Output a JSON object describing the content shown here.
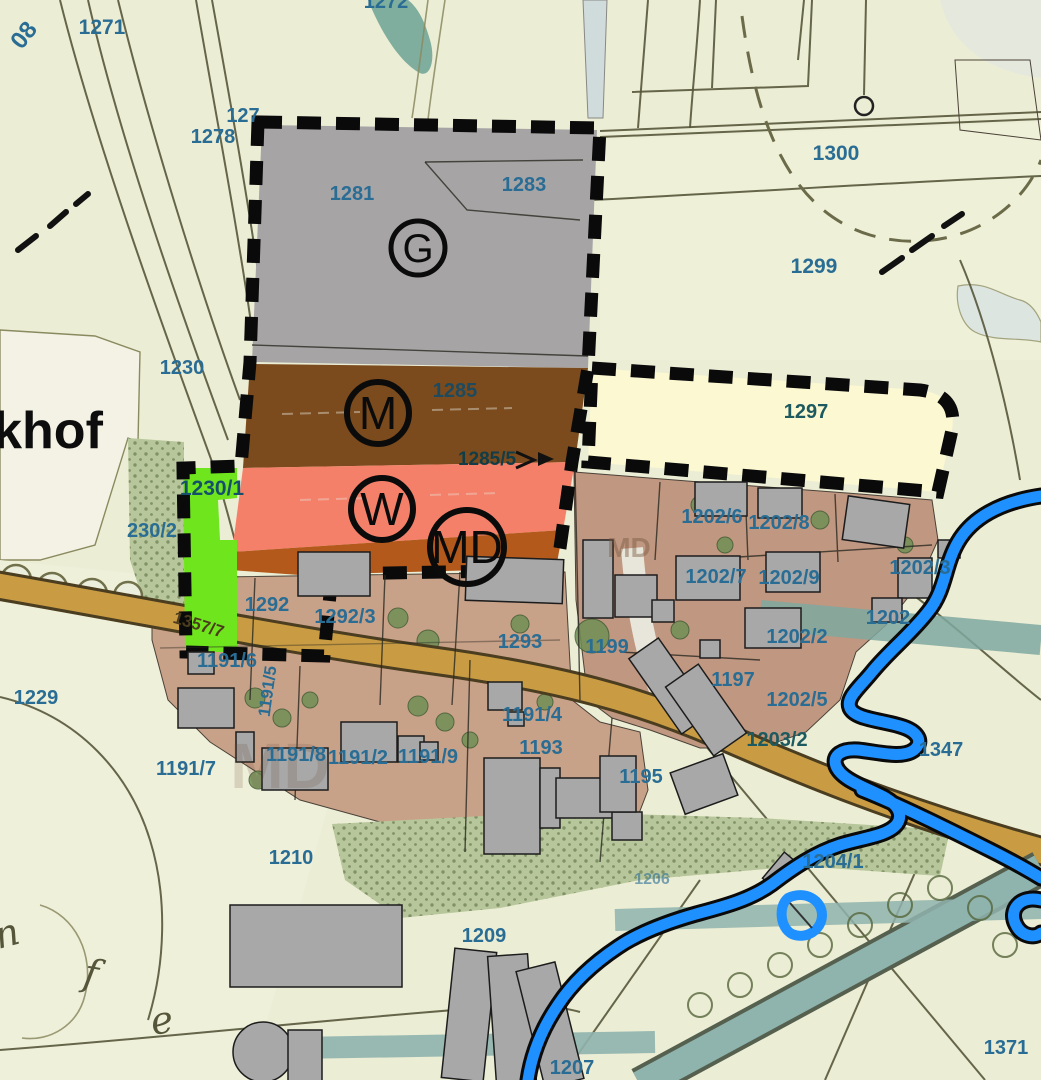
{
  "map": {
    "title": "zoning-plan-map",
    "colors": {
      "bg": "#ecedd5",
      "field_cream": "#f3f2e4",
      "zone_g": "#a7a4a6",
      "zone_m": "#7b4b1d",
      "zone_w": "#f5806a",
      "zone_md": "#b2591b",
      "zone_green": "#6fe51e",
      "zone_cream": "#fbf8d2",
      "res_left": "#c8a189",
      "res_right": "#c09780",
      "building": "#a8a8a8",
      "road_tan": "#c99c44",
      "road_edge": "#4a3d20",
      "river_blue": "#1e90ff",
      "water_teal": "#8fb3ad",
      "forest_green": "#b7c79b",
      "tree_green": "#6f8f55",
      "label_blue": "#2a6d94",
      "label_dark": "#14506a",
      "boundary_black": "#0a0a0a"
    },
    "zone_markers": [
      {
        "letter": "G",
        "x": 418,
        "y": 248,
        "r": 27,
        "font": 40,
        "stroke": 5
      },
      {
        "letter": "M",
        "x": 378,
        "y": 413,
        "r": 31,
        "font": 46,
        "stroke": 6
      },
      {
        "letter": "W",
        "x": 382,
        "y": 509,
        "r": 31,
        "font": 46,
        "stroke": 6
      },
      {
        "letter": "MD",
        "x": 467,
        "y": 547,
        "r": 37,
        "font": 46,
        "stroke": 6
      }
    ],
    "labels": [
      {
        "text": "1272",
        "x": 386,
        "y": 8,
        "size": 20
      },
      {
        "text": "08",
        "x": 30,
        "y": 40,
        "size": 24,
        "rot": -52
      },
      {
        "text": "1271",
        "x": 102,
        "y": 34,
        "size": 21
      },
      {
        "text": "127",
        "x": 243,
        "y": 122,
        "size": 20
      },
      {
        "text": "1278",
        "x": 213,
        "y": 143,
        "size": 20
      },
      {
        "text": "1281",
        "x": 352,
        "y": 200,
        "size": 20
      },
      {
        "text": "1283",
        "x": 524,
        "y": 191,
        "size": 20
      },
      {
        "text": "1300",
        "x": 836,
        "y": 160,
        "size": 21
      },
      {
        "text": "1299",
        "x": 814,
        "y": 273,
        "size": 21
      },
      {
        "text": "1230",
        "x": 182,
        "y": 374,
        "size": 20
      },
      {
        "text": "khof",
        "x": 48,
        "y": 448,
        "size": 52,
        "color": "#0d0d0d",
        "weight": "600",
        "name": "place-name"
      },
      {
        "text": "1285",
        "x": 455,
        "y": 397,
        "size": 20,
        "color": "#1d4a5e"
      },
      {
        "text": "1285/5",
        "x": 487,
        "y": 465,
        "size": 19,
        "color": "#123c46"
      },
      {
        "text": "1297",
        "x": 806,
        "y": 418,
        "size": 20,
        "color": "#1d5a60"
      },
      {
        "text": "1230/1",
        "x": 212,
        "y": 495,
        "size": 21,
        "color": "#14506a"
      },
      {
        "text": "230/2",
        "x": 152,
        "y": 537,
        "size": 20
      },
      {
        "text": "1202/6",
        "x": 712,
        "y": 523,
        "size": 20
      },
      {
        "text": "1202/8",
        "x": 779,
        "y": 529,
        "size": 20
      },
      {
        "text": "MD",
        "x": 629,
        "y": 557,
        "size": 28,
        "color": "#7a5a40",
        "opacity": 0.45
      },
      {
        "text": "MD",
        "x": 280,
        "y": 788,
        "size": 64,
        "color": "#6a4a34",
        "opacity": 0.18
      },
      {
        "text": "1202/7",
        "x": 716,
        "y": 583,
        "size": 20
      },
      {
        "text": "1202/9",
        "x": 789,
        "y": 584,
        "size": 20
      },
      {
        "text": "1202/3",
        "x": 920,
        "y": 574,
        "size": 20
      },
      {
        "text": "1202",
        "x": 888,
        "y": 624,
        "size": 20
      },
      {
        "text": "1202/2",
        "x": 797,
        "y": 643,
        "size": 20
      },
      {
        "text": "1292",
        "x": 267,
        "y": 611,
        "size": 20
      },
      {
        "text": "1292/3",
        "x": 345,
        "y": 623,
        "size": 20
      },
      {
        "text": "1293",
        "x": 520,
        "y": 648,
        "size": 20
      },
      {
        "text": "1199",
        "x": 607,
        "y": 653,
        "size": 20
      },
      {
        "text": "1357/7",
        "x": 197,
        "y": 630,
        "size": 17,
        "rot": 17,
        "color": "#4a3c1c"
      },
      {
        "text": "1191/6",
        "x": 227,
        "y": 667,
        "size": 20
      },
      {
        "text": "1191/5",
        "x": 273,
        "y": 692,
        "size": 17,
        "rot": -82
      },
      {
        "text": "1197",
        "x": 733,
        "y": 686,
        "size": 20
      },
      {
        "text": "1202/5",
        "x": 797,
        "y": 706,
        "size": 20
      },
      {
        "text": "1229",
        "x": 36,
        "y": 704,
        "size": 20
      },
      {
        "text": "1203/2",
        "x": 777,
        "y": 746,
        "size": 20,
        "color": "#1d5a60"
      },
      {
        "text": "1347",
        "x": 941,
        "y": 756,
        "size": 20
      },
      {
        "text": "1191/7",
        "x": 186,
        "y": 775,
        "size": 20
      },
      {
        "text": "1191/8",
        "x": 296,
        "y": 761,
        "size": 20
      },
      {
        "text": "1191/2",
        "x": 358,
        "y": 764,
        "size": 20
      },
      {
        "text": "1191/9",
        "x": 428,
        "y": 763,
        "size": 20
      },
      {
        "text": "1191/4",
        "x": 532,
        "y": 721,
        "size": 20
      },
      {
        "text": "1193",
        "x": 541,
        "y": 754,
        "size": 20
      },
      {
        "text": "1195",
        "x": 641,
        "y": 783,
        "size": 20
      },
      {
        "text": "1210",
        "x": 291,
        "y": 864,
        "size": 20
      },
      {
        "text": "1204/1",
        "x": 833,
        "y": 868,
        "size": 20
      },
      {
        "text": "1206",
        "x": 652,
        "y": 884,
        "size": 16,
        "opacity": 0.6
      },
      {
        "text": "1209",
        "x": 484,
        "y": 942,
        "size": 20
      },
      {
        "text": "1207",
        "x": 572,
        "y": 1074,
        "size": 20
      },
      {
        "text": "1371",
        "x": 1006,
        "y": 1054,
        "size": 20
      },
      {
        "text": "n",
        "x": 10,
        "y": 946,
        "size": 38,
        "rot": -15,
        "color": "#55553a",
        "name": "cursive-letter"
      },
      {
        "text": "f",
        "x": 89,
        "y": 986,
        "size": 38,
        "rot": 10,
        "color": "#55553a",
        "name": "cursive-letter"
      },
      {
        "text": "e",
        "x": 164,
        "y": 1033,
        "size": 38,
        "rot": -10,
        "color": "#55553a",
        "name": "cursive-letter"
      }
    ]
  }
}
